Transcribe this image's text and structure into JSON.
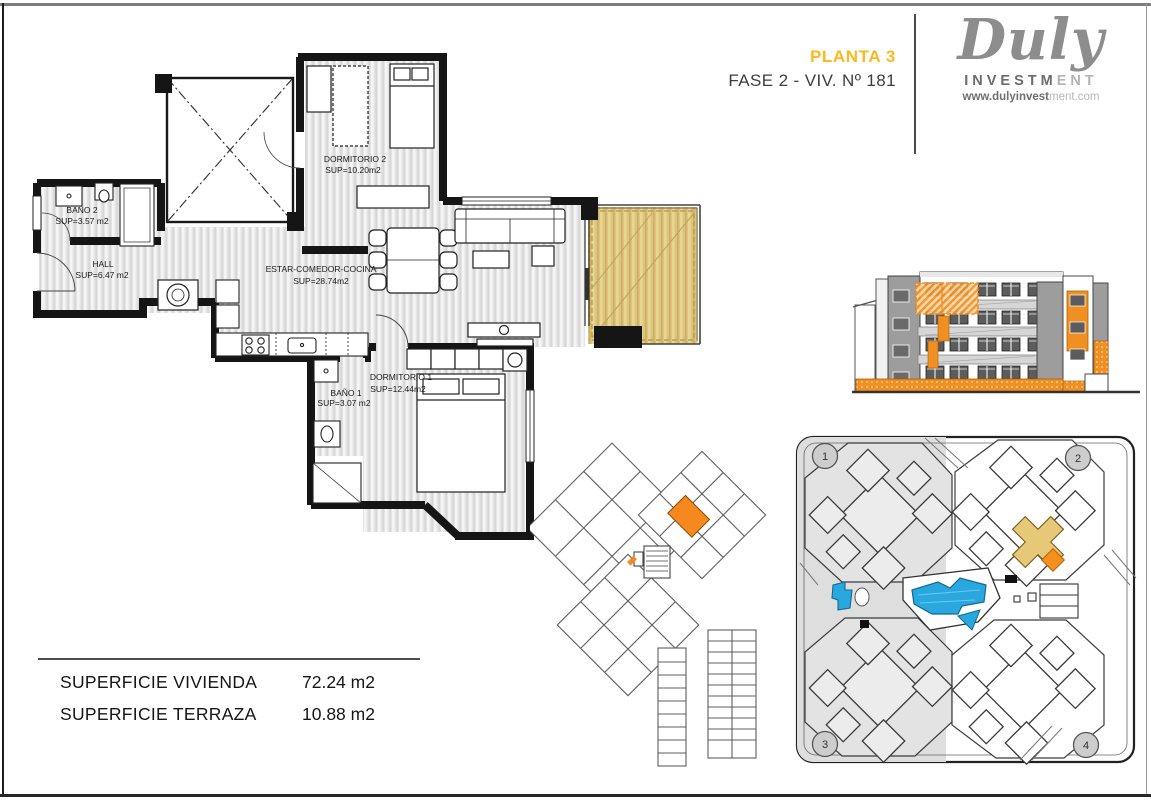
{
  "header": {
    "planta": "PLANTA 3",
    "fase": "FASE 2 - VIV.  Nº 181"
  },
  "logo": {
    "brand": "Duly",
    "investment_strong": "INVESTM",
    "investment_light": "ENT",
    "url_strong": "www.dulyinvest",
    "url_light": "ment.com"
  },
  "floorplan": {
    "rooms": [
      {
        "name": "DORMITORIO 2",
        "sup": "SUP=10.20m2"
      },
      {
        "name": "BAÑO 2",
        "sup": "SUP=3.57 m2"
      },
      {
        "name": "HALL",
        "sup": "SUP=6.47 m2"
      },
      {
        "name": "ESTAR-COMEDOR-COCINA",
        "sup": "SUP=28.74m2"
      },
      {
        "name": "DORMITORIO 1",
        "sup": "SUP=12.44m2"
      },
      {
        "name": "BAÑO 1",
        "sup": "SUP=3.07 m2"
      }
    ]
  },
  "summary": {
    "rows": [
      {
        "label": "SUPERFICIE VIVIENDA",
        "value": "72.24 m2"
      },
      {
        "label": "SUPERFICIE TERRAZA",
        "value": "10.88 m2"
      }
    ]
  },
  "siteplan": {
    "markers": [
      "1",
      "2",
      "3",
      "4"
    ]
  },
  "colors": {
    "accent_orange": "#F7941E",
    "planta_gold": "#FFB81C",
    "terrace_tan": "#DCC47C",
    "site_highlight_tan": "#E6C878",
    "pool_blue": "#29A8E0",
    "logo_gray": "#8D8D8D"
  }
}
